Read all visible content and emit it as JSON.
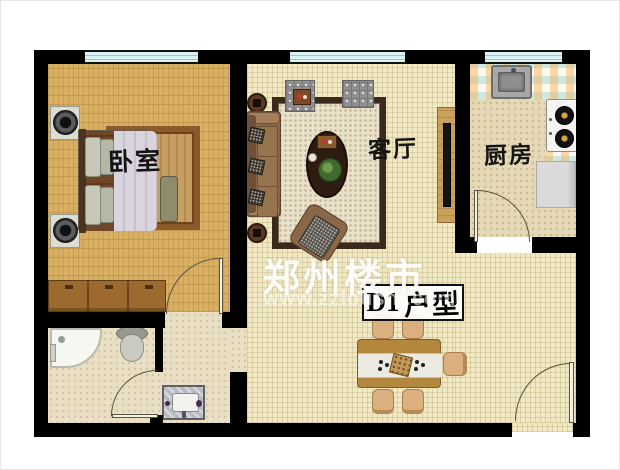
{
  "watermark": {
    "title": "郑州楼市",
    "url": "www.zzloushi.com"
  },
  "unit": {
    "prefix": "D1",
    "suffix": "户型"
  },
  "rooms": {
    "bedroom": {
      "label": "卧室"
    },
    "living": {
      "label": "客厅"
    },
    "kitchen": {
      "label": "厨房"
    }
  },
  "colors": {
    "wall": "#000000",
    "window": "#d9f2f3",
    "window_line": "#8fcdd3",
    "floor_bedroom": "#d8af63",
    "floor_living": "#f1e8c4",
    "floor_kitchen": "#e4d8b6",
    "floor_bath": "#e9dfc4",
    "rug_living": "#eae1cb",
    "rug_border_living": "#3a2a1c",
    "rug_bedroom": "#c79f63",
    "rug_border_bedroom": "#8a5a2b",
    "sofa": "#8a6746",
    "wood": "#9c6a2e",
    "table_dining": "#b3873e",
    "chair": "#d9b07e",
    "watermark": "#ffffff"
  }
}
